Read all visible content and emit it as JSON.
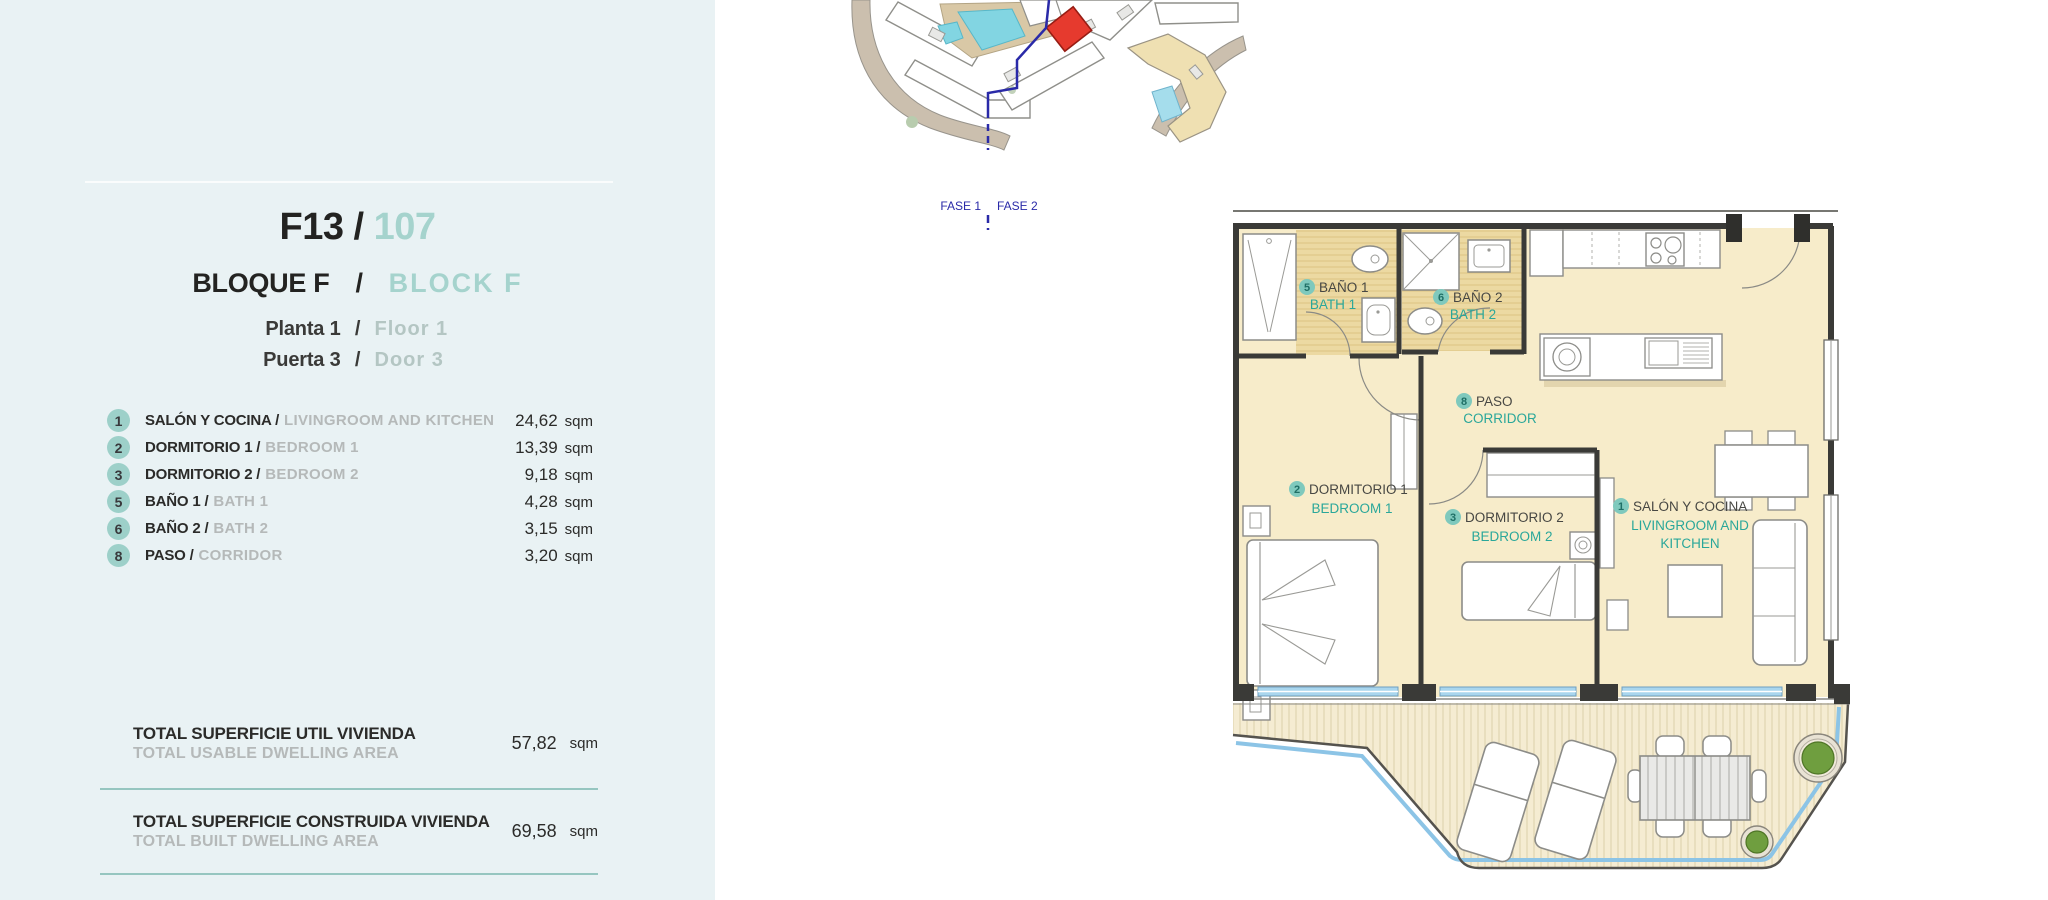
{
  "panel": {
    "unit_code": "F13",
    "separator": "/",
    "unit_number": "107",
    "block_es": "BLOQUE F",
    "block_en": "BLOCK F",
    "floor_es": "Planta 1",
    "floor_en": "Floor 1",
    "door_es": "Puerta 3",
    "door_en": "Door 3",
    "rooms": [
      {
        "num": "1",
        "es": "SALÓN Y COCINA /",
        "en": "LIVINGROOM AND KITCHEN",
        "area": "24,62",
        "unit": "sqm"
      },
      {
        "num": "2",
        "es": "DORMITORIO 1 /",
        "en": "BEDROOM 1",
        "area": "13,39",
        "unit": "sqm"
      },
      {
        "num": "3",
        "es": "DORMITORIO 2 /",
        "en": "BEDROOM 2",
        "area": "9,18",
        "unit": "sqm"
      },
      {
        "num": "5",
        "es": "BAÑO 1 /",
        "en": "BATH 1",
        "area": "4,28",
        "unit": "sqm"
      },
      {
        "num": "6",
        "es": "BAÑO 2 /",
        "en": "BATH 2",
        "area": "3,15",
        "unit": "sqm"
      },
      {
        "num": "8",
        "es": "PASO /",
        "en": "CORRIDOR",
        "area": "3,20",
        "unit": "sqm"
      }
    ],
    "totals": [
      {
        "es": "TOTAL SUPERFICIE UTIL VIVIENDA",
        "en": "TOTAL USABLE DWELLING AREA",
        "value": "57,82",
        "unit": "sqm"
      },
      {
        "es": "TOTAL SUPERFICIE CONSTRUIDA VIVIENDA",
        "en": "TOTAL BUILT DWELLING AREA",
        "value": "69,58",
        "unit": "sqm"
      },
      {
        "es": "TOTAL SUPERFICIE CONSTRUIDA TERRAZA",
        "en": "",
        "value": "",
        "unit": ""
      }
    ]
  },
  "site_map": {
    "fase_1": "FASE 1",
    "fase_2": "FASE 2"
  },
  "plan": {
    "bath1": {
      "num": "5",
      "es": "BAÑO 1",
      "en": "BATH 1"
    },
    "bath2": {
      "num": "6",
      "es": "BAÑO 2",
      "en": "BATH 2"
    },
    "corridor": {
      "num": "8",
      "es": "PASO",
      "en": "CORRIDOR"
    },
    "bedroom1": {
      "num": "2",
      "es": "DORMITORIO 1",
      "en": "BEDROOM 1"
    },
    "bedroom2": {
      "num": "3",
      "es": "DORMITORIO 2",
      "en": "BEDROOM 2"
    },
    "living": {
      "num": "1",
      "es": "SALÓN Y COCINA",
      "en_line1": "LIVINGROOM AND",
      "en_line2": "KITCHEN"
    }
  },
  "colors": {
    "panel_bg": "#e9f2f4",
    "accent_teal_light": "#a5d3cd",
    "badge_teal": "#9dd0c9",
    "divider_teal": "#96c6c0",
    "plan_label_teal": "#2aa79a",
    "room_fill": "#f7ecca",
    "bath_fill": "#ecd9a2",
    "window_blue": "#a9d6ee",
    "highlight_red": "#e63a2e",
    "phase_blue": "#2a2aa8"
  }
}
